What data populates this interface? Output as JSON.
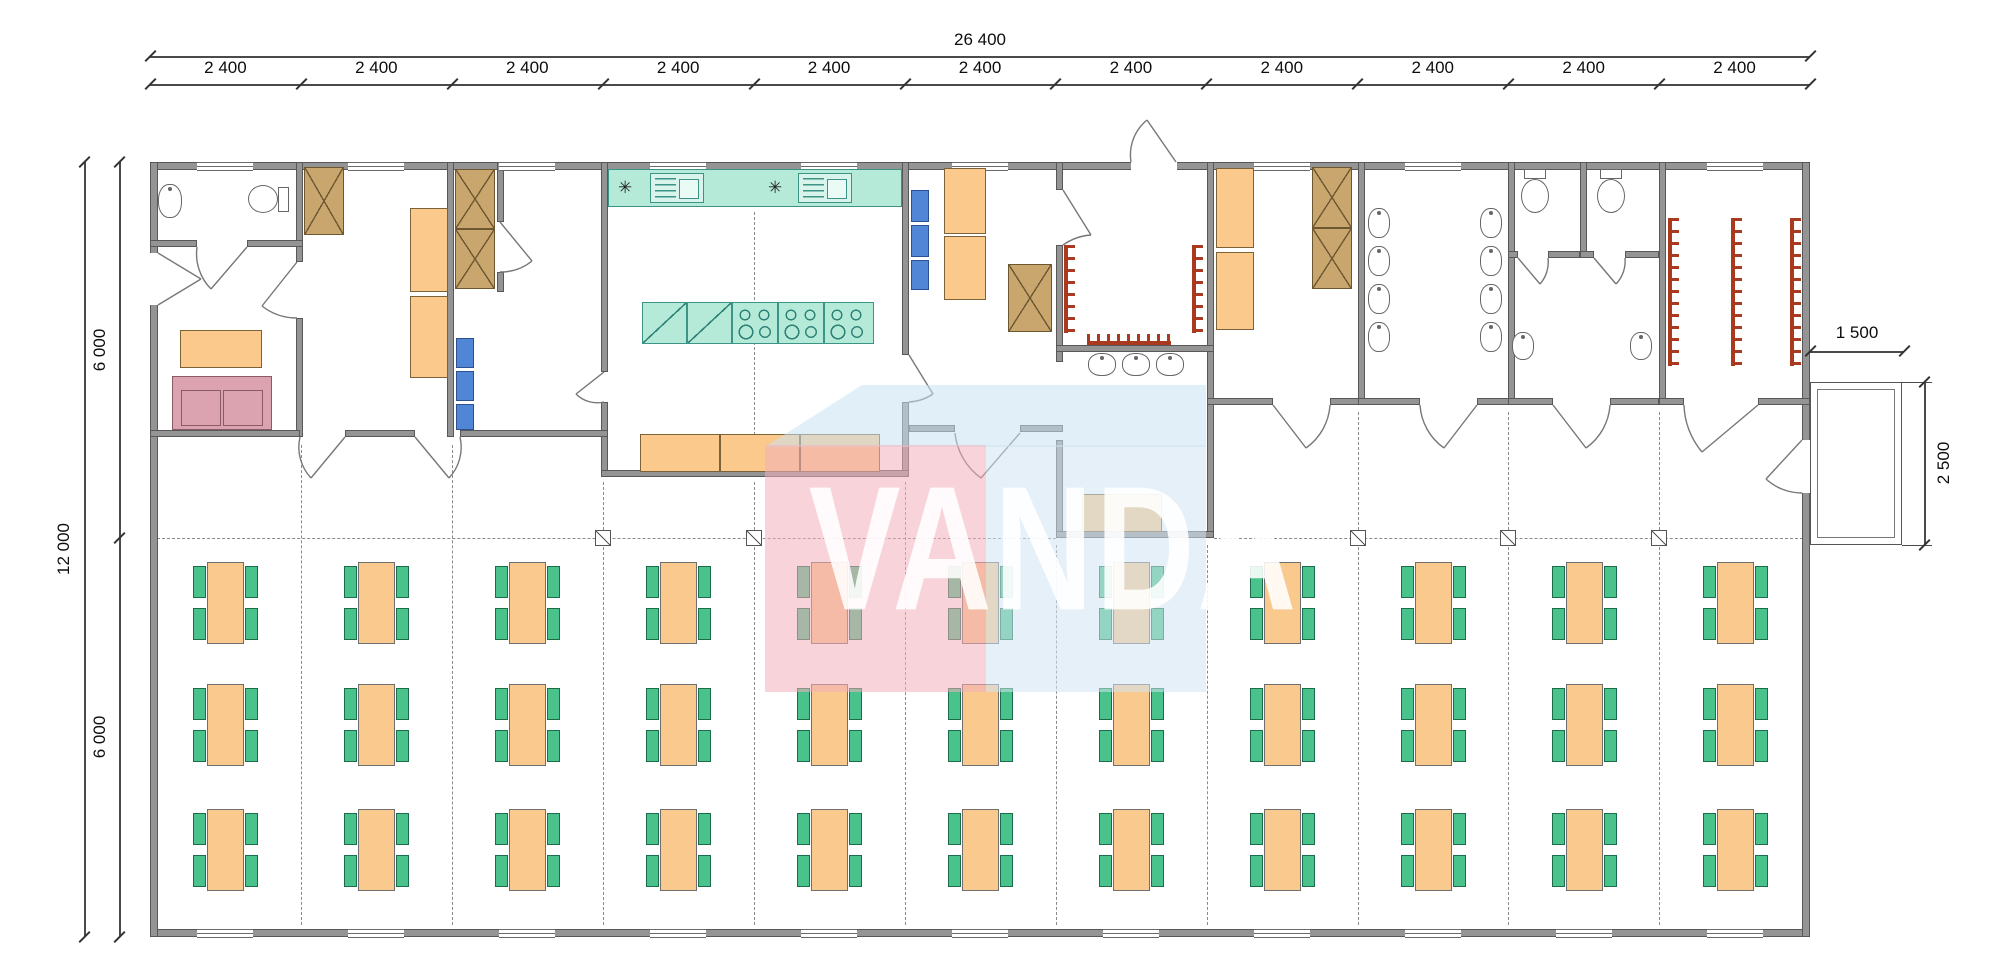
{
  "dimensions": {
    "top_total": "26 400",
    "top_bays": [
      "2 400",
      "2 400",
      "2 400",
      "2 400",
      "2 400",
      "2 400",
      "2 400",
      "2 400",
      "2 400",
      "2 400",
      "2 400"
    ],
    "left_total": "12 000",
    "left_upper": "6 000",
    "left_lower": "6 000",
    "porch_width": "1 500",
    "porch_depth": "2 500"
  },
  "watermark": {
    "text": "VANDA",
    "pink": "#f2aebc",
    "blue_top": "#c8e2f4",
    "blue_right": "#cfe3f2"
  },
  "symbols": {
    "lamp": "✳"
  },
  "dining": {
    "columns": 11,
    "rows": 3,
    "tables": 33,
    "chairs_per_table": 4
  },
  "palette": {
    "wall": "#949494",
    "furniture_wood": "#fbc98b",
    "wardrobe": "#c9a66e",
    "kitchen_units": "#b5ead9",
    "lockers": "#5186d7",
    "chairs": "#49c28b",
    "sofa": "#dba3b0",
    "coat_hooks": "#a93a20"
  }
}
